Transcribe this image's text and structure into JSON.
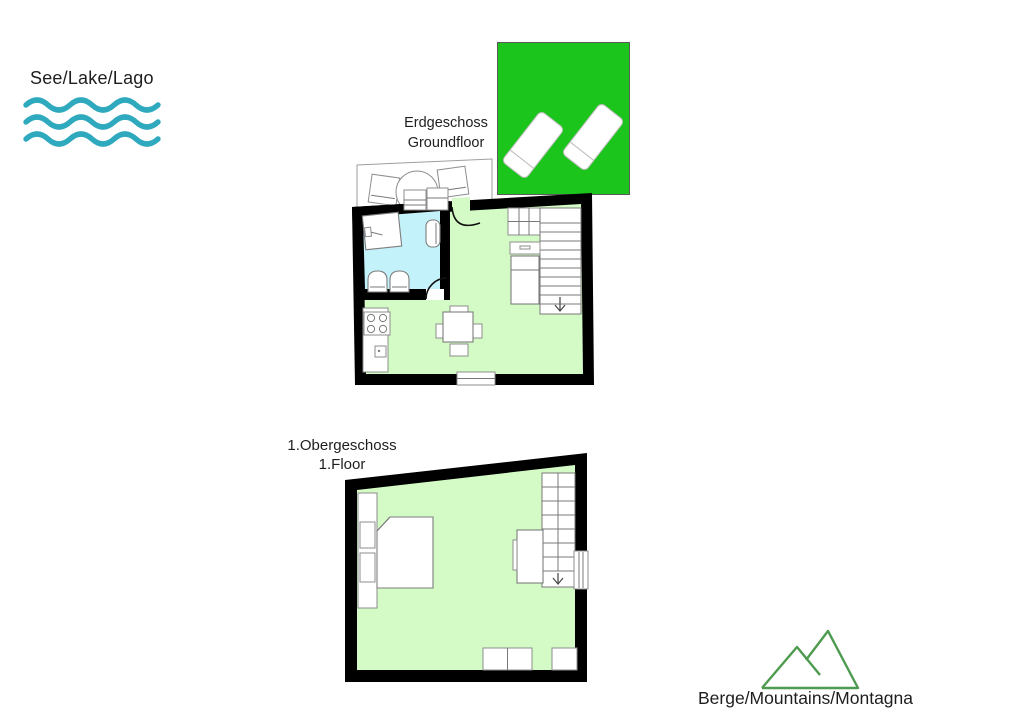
{
  "legend": {
    "lake": {
      "label": "See/Lake/Lago",
      "icon": "waves-icon"
    },
    "mountains": {
      "label": "Berge/Mountains/Montagna",
      "icon": "mountains-icon"
    }
  },
  "floors": {
    "ground": {
      "title_de": "Erdgeschoss",
      "title_en": "Groundfloor"
    },
    "first": {
      "title_de": "1.Obergeschoss",
      "title_en": "1.Floor"
    }
  },
  "colors": {
    "lawn_green": "#1cc51c",
    "bathroom_blue": "#c4f2fa",
    "floor_green": "#d4fac6",
    "wave_teal": "#2fa9bd",
    "mountain_green": "#4e9b50",
    "wall_black": "#000000"
  }
}
